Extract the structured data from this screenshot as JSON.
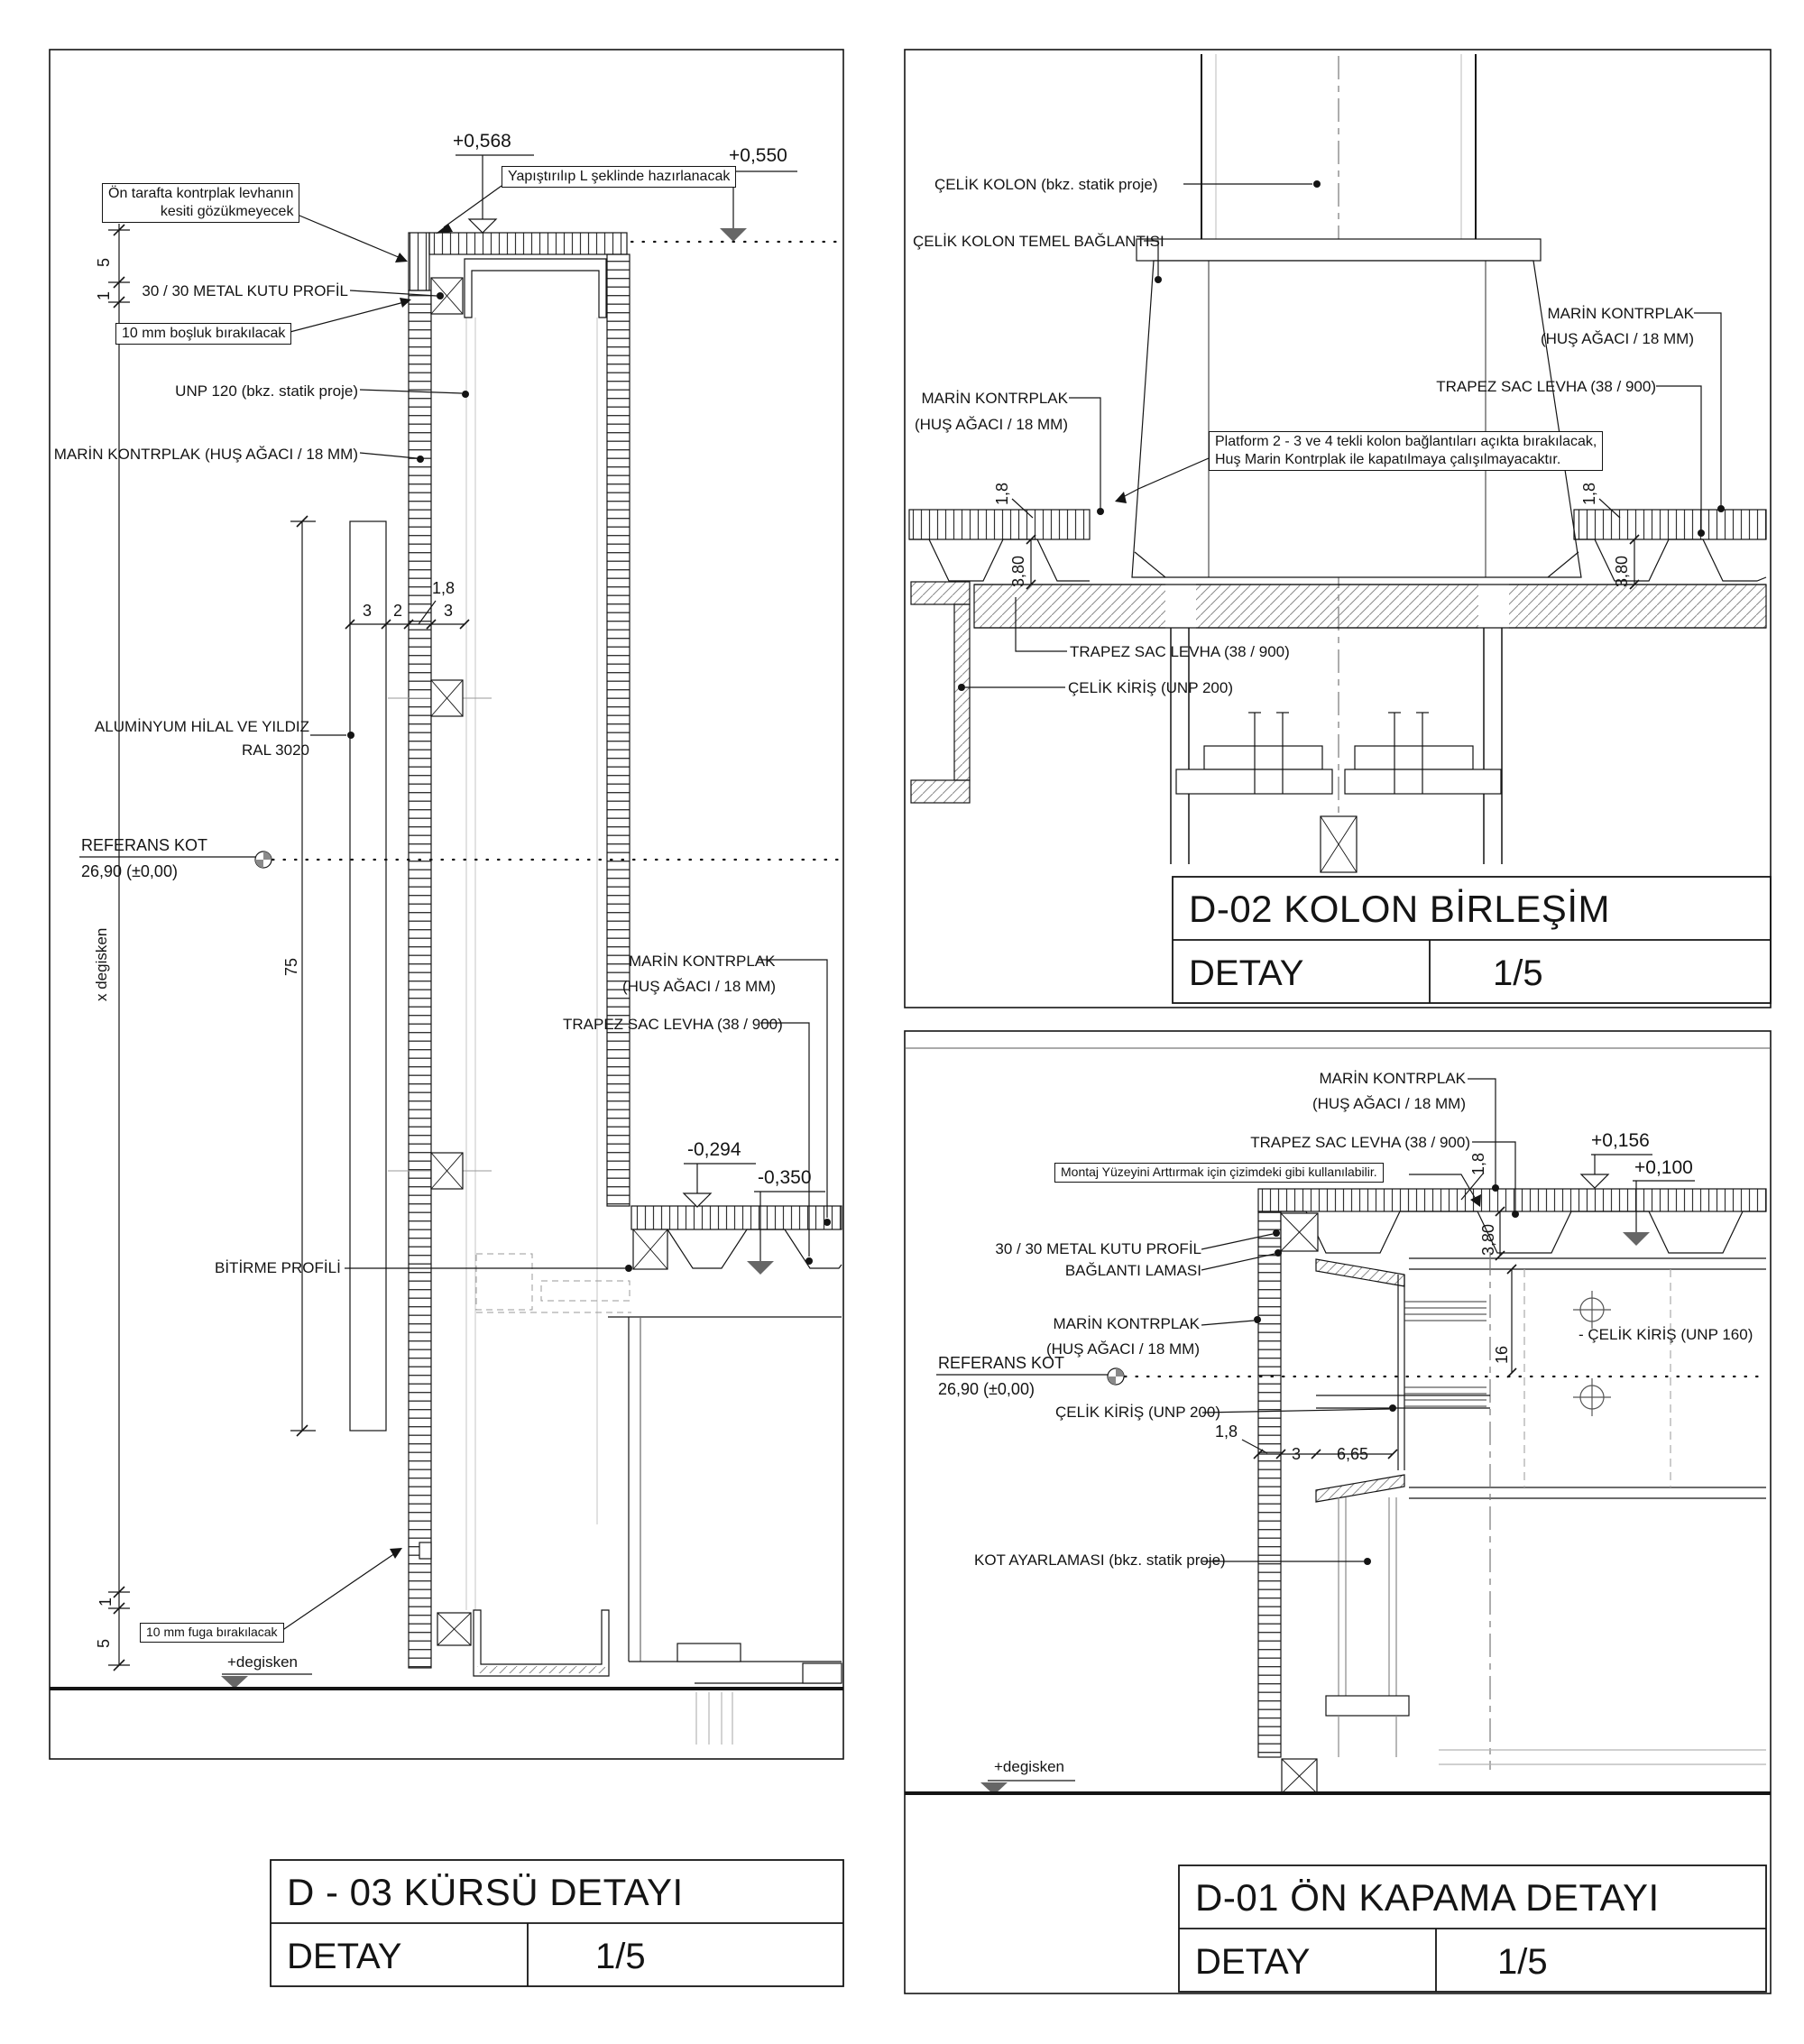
{
  "sheet": {
    "background": "#ffffff",
    "ink": "#141414",
    "hidden_line_gray": "#b5b5b5",
    "fill_marker_gray": "#666666"
  },
  "panels": {
    "d03": {
      "title": "D - 03 KÜRSÜ DETAYI",
      "type_label": "DETAY",
      "scale": "1/5",
      "labels": {
        "level_0568": "+0,568",
        "note_yapistirilip": "Yapıştırılıp L şeklinde hazırlanacak",
        "level_0550": "+0,550",
        "note_on_tarafta_line1": "Ön tarafta kontrplak levhanın",
        "note_on_tarafta_line2": "kesiti gözükmeyecek",
        "dim_5_top": "5",
        "dim_1_top": "1",
        "metal_kutu": "30 / 30 METAL KUTU PROFİL",
        "note_bosluk": "10 mm boşluk bırakılacak",
        "unp120": "UNP 120 (bkz. statik proje)",
        "marin_kontrplak": "MARİN KONTRPLAK  (HUŞ AĞACI / 18 MM)",
        "dim_1_8": "1,8",
        "dim_3_left": "3",
        "dim_2": "2",
        "dim_3_right": "3",
        "aluminyum_line1": "ALUMİNYUM HİLAL VE YILDIZ",
        "aluminyum_line2": "RAL 3020",
        "referans_kot_line1": "REFERANS KOT",
        "referans_kot_line2": "26,90  (±0,00)",
        "x_degisken": "x degisken",
        "dim_75": "75",
        "marin_r_line1": "MARİN KONTRPLAK",
        "marin_r_line2": "(HUŞ AĞACI / 18 MM)",
        "trapez_sac": "TRAPEZ SAC LEVHA (38 / 900)",
        "level_m0294": "-0,294",
        "level_m0350": "-0,350",
        "bitirme_profili": "BİTİRME PROFİLİ",
        "note_fuga": "10 mm fuga bırakılacak",
        "dim_1_bottom": "1",
        "dim_5_bottom": "5",
        "plus_degisken": "+degisken"
      }
    },
    "d02": {
      "title": "D-02 KOLON BİRLEŞİM",
      "type_label": "DETAY",
      "scale": "1/5",
      "labels": {
        "celik_kolon": "ÇELİK KOLON (bkz. statik proje)",
        "temel_baglantisi": "ÇELİK KOLON TEMEL BAĞLANTISI",
        "marin_l_line1": "MARİN KONTRPLAK",
        "marin_l_line2": "(HUŞ AĞACI / 18 MM)",
        "marin_r_line1": "MARİN KONTRPLAK",
        "marin_r_line2": "(HUŞ AĞACI / 18 MM)",
        "trapez_right": "TRAPEZ SAC LEVHA (38 / 900)",
        "note_platform_line1": "Platform 2 - 3 ve 4 tekli kolon bağlantıları açıkta bırakılacak,",
        "note_platform_line2": "Huş Marin Kontrplak ile kapatılmaya çalışılmayacaktır.",
        "dim_1_8_left": "1,8",
        "dim_3_80_left": "3,80",
        "dim_1_8_right": "1,8",
        "dim_3_80_right": "3,80",
        "trapez_bottom": "TRAPEZ SAC LEVHA (38 / 900)",
        "celik_kiris": "ÇELİK KİRİŞ (UNP 200)"
      }
    },
    "d01": {
      "title": "D-01 ÖN KAPAMA DETAYI",
      "type_label": "DETAY",
      "scale": "1/5",
      "labels": {
        "marin_t_line1": "MARİN KONTRPLAK",
        "marin_t_line2": "(HUŞ AĞACI / 18 MM)",
        "trapez": "TRAPEZ SAC LEVHA (38 / 900)",
        "note_montaj": "Montaj Yüzeyini Arttırmak için çizimdeki gibi kullanılabilir.",
        "level_0156": "+0,156",
        "level_0100": "+0,100",
        "dim_1_8_top": "1,8",
        "dim_3_80": "3,80",
        "metal_kutu": "30 / 30 METAL KUTU PROFİL",
        "baglanti_lamasi": "BAĞLANTI LAMASI",
        "marin_m_line1": "MARİN KONTRPLAK",
        "marin_m_line2": "(HUŞ AĞACI / 18 MM)",
        "referans_kot_line1": "REFERANS KOT",
        "referans_kot_line2": "26,90  (±0,00)",
        "celik_kiris_200": "ÇELİK KİRİŞ (UNP 200)",
        "celik_kiris_160": "- ÇELİK KİRİŞ (UNP 160)",
        "dim_1_8_bottom": "1,8",
        "dim_3": "3",
        "dim_6_65": "6,65",
        "dim_16": "16",
        "kot_ayarlamasi": "KOT AYARLAMASI (bkz. statik proje)",
        "plus_degisken": "+degisken"
      }
    }
  }
}
